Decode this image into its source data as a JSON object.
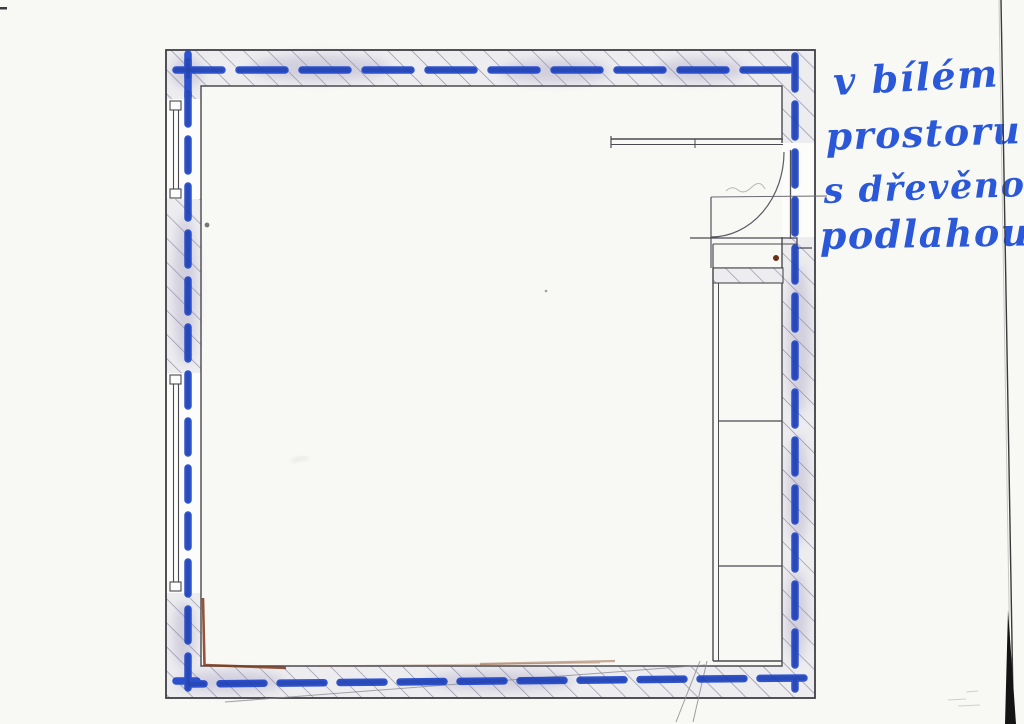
{
  "document": {
    "kind": "scanned floor plan sketch with marker annotation",
    "note": {
      "language": "cs",
      "full_text": "v bílém prostoru s dřevěnou podlahou",
      "lines": [
        "v bílém",
        "prostoru",
        "s dřevěnou",
        "podlahou"
      ],
      "color": "#2b58d8"
    },
    "plan": {
      "outline": "square room, hatched masonry walls",
      "features": [
        "upper-left window",
        "lower-left window",
        "top-right door with quarter-circle swing arc",
        "right-side shelving / closet column with two dividers",
        "blue marker dashed line tracing the inner wall perimeter"
      ]
    },
    "colors": {
      "paper": "#f8f8f5",
      "plan_line": "#3f3f45",
      "wall_fill": "#ededf0",
      "hatch_line": "#8f8fa3",
      "marker_blue": "#1e46cc",
      "accent_brown": "#7c3a1c"
    }
  }
}
